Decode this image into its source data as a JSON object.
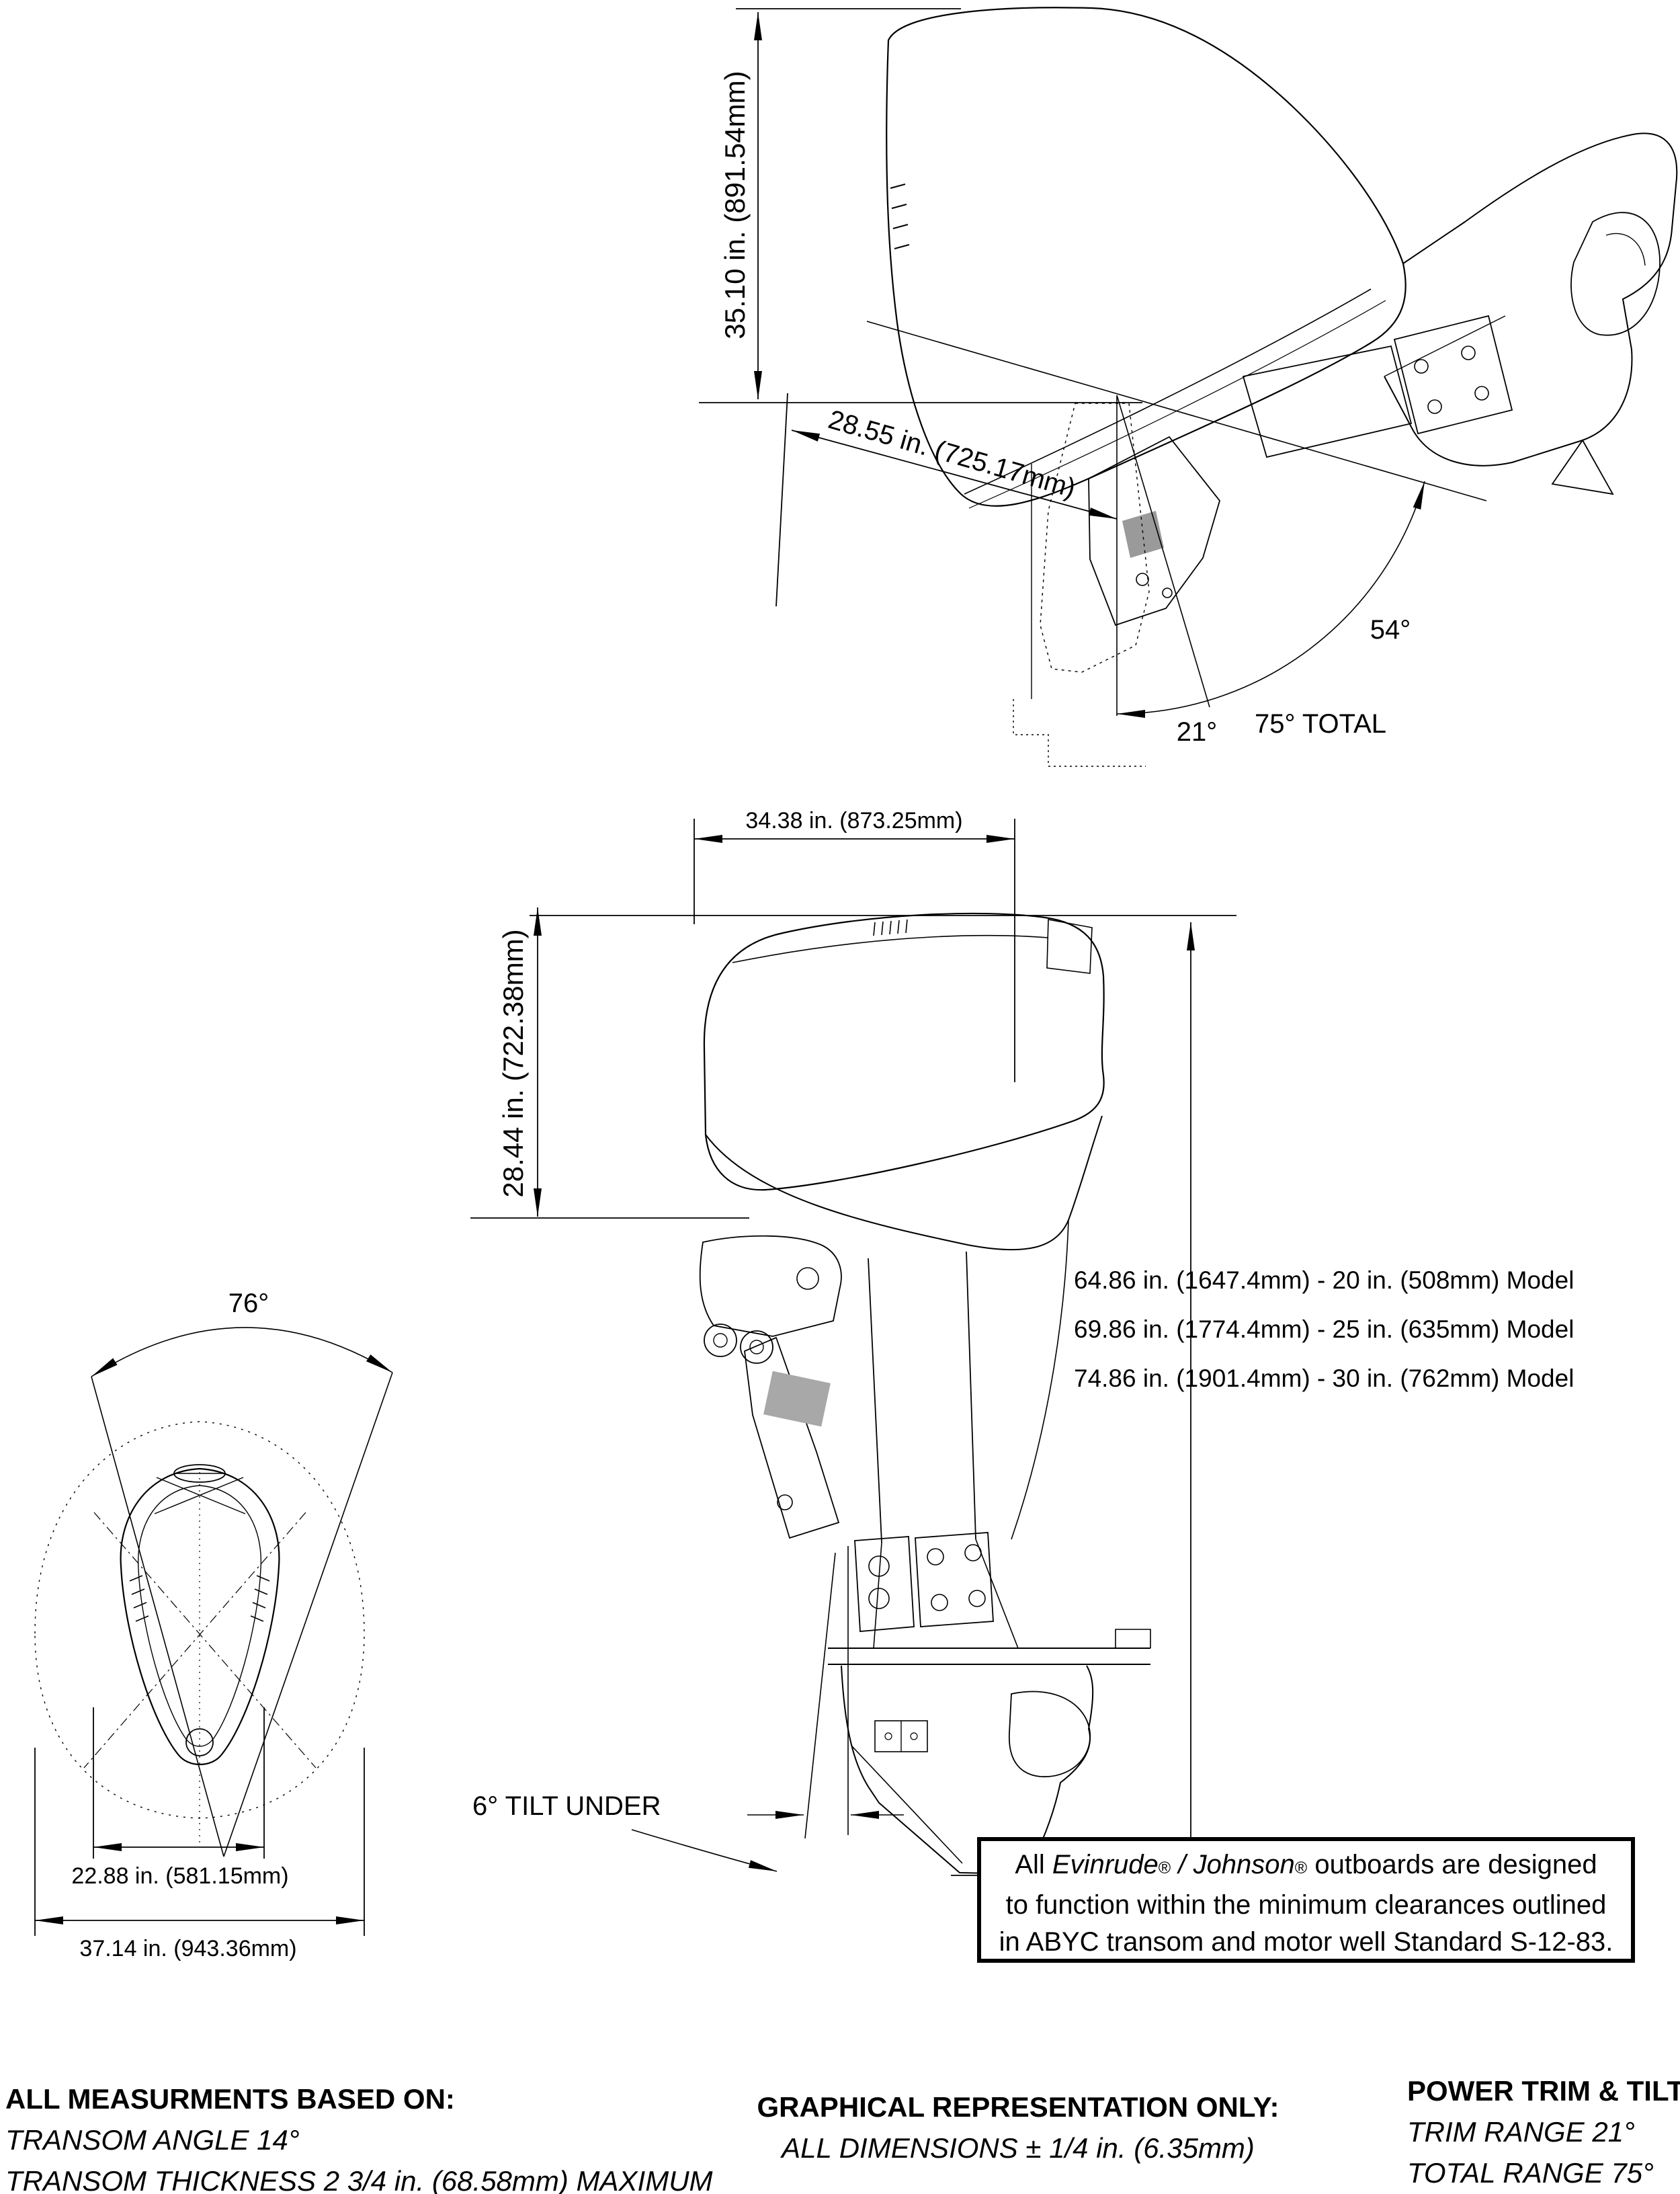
{
  "top_diagram": {
    "height_dim": "35.10 in. (891.54mm)",
    "length_dim": "28.55 in. (725.17mm)",
    "tilt_angle": "54°",
    "trim_angle": "21°",
    "total_angle": "75° TOTAL"
  },
  "side_diagram": {
    "width_dim": "34.38 in. (873.25mm)",
    "height_dim": "28.44 in. (722.38mm)",
    "models": [
      "64.86 in. (1647.4mm) - 20 in. (508mm) Model",
      "69.86 in. (1774.4mm) - 25 in. (635mm) Model",
      "74.86 in. (1901.4mm) - 30 in. (762mm) Model"
    ],
    "tilt_under": "6° TILT UNDER"
  },
  "front_diagram": {
    "steering_angle": "76°",
    "inner_width_dim": "22.88 in. (581.15mm)",
    "outer_width_dim": "37.14 in. (943.36mm)"
  },
  "note_box": {
    "line1_pre": "All ",
    "brand1": "Evinrude",
    "reg1": "®",
    "line1_mid": " / ",
    "brand2": "Johnson",
    "reg2": "®",
    "line1_post": " outboards are designed",
    "line2": "to function within the minimum clearances outlined",
    "line3": "in ABYC transom and motor well Standard S-12-83."
  },
  "footer": {
    "col1_title": "ALL MEASURMENTS BASED ON:",
    "col1_line1": "TRANSOM ANGLE 14°",
    "col1_line2": "TRANSOM THICKNESS 2 3/4 in. (68.58mm) MAXIMUM",
    "col2_title": "GRAPHICAL REPRESENTATION ONLY:",
    "col2_line1": "ALL DIMENSIONS ± 1/4 in. (6.35mm)",
    "col3_title": "POWER TRIM & TILT:",
    "col3_line1": "TRIM RANGE 21°",
    "col3_line2": "TOTAL RANGE 75°"
  }
}
